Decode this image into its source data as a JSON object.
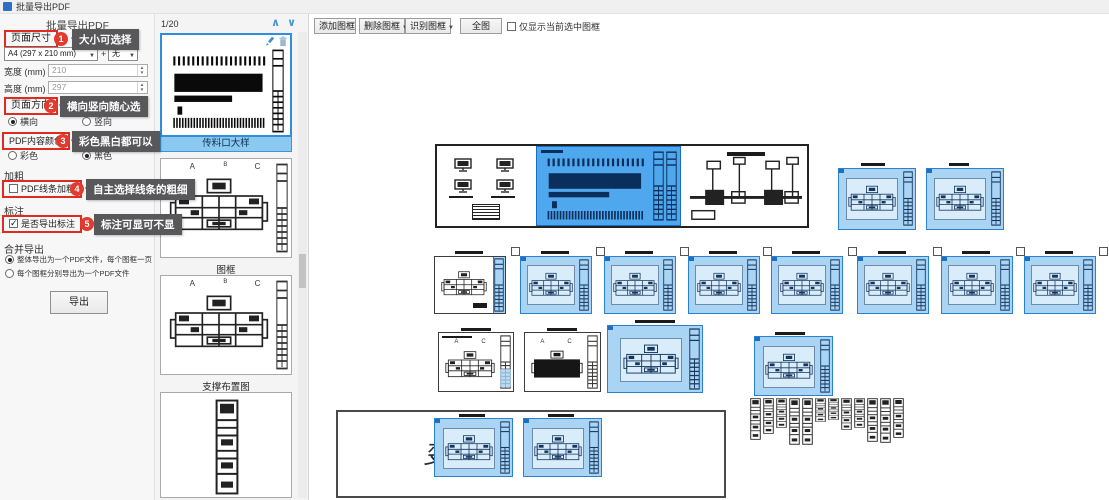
{
  "window": {
    "title": "批量导出PDF"
  },
  "panel": {
    "header": "批量导出PDF",
    "page_size": {
      "label": "页面尺寸",
      "badge": "1",
      "tooltip": "大小可选择",
      "size_value": "A4 (297 x 210 mm)",
      "plus": "+",
      "none_value": "无"
    },
    "width_field": {
      "label": "宽度 (mm)",
      "value": "210"
    },
    "height_field": {
      "label": "高度 (mm)",
      "value": "297"
    },
    "orientation": {
      "label": "页面方向",
      "badge": "2",
      "tooltip": "横向竖向随心选",
      "option_landscape": "横向",
      "option_portrait": "竖向"
    },
    "color": {
      "label": "PDF内容颜色",
      "badge": "3",
      "tooltip": "彩色黑白都可以",
      "option_color": "彩色",
      "option_black": "黑色"
    },
    "bold": {
      "group": "加粗",
      "label": "PDF线条加粗",
      "badge": "4",
      "tooltip": "自主选择线条的粗细"
    },
    "annotation": {
      "group": "标注",
      "label": "是否导出标注",
      "badge": "5",
      "tooltip": "标注可显可不显"
    },
    "merge": {
      "group": "合并导出",
      "options": [
        "整体导出为一个PDF文件，每个图框一页",
        "每个图框分别导出为一个PDF文件"
      ]
    },
    "export_button": "导出"
  },
  "thumbnails": {
    "page_indicator": "1/20",
    "items": [
      {
        "label": "传料口大样"
      },
      {
        "label": "图框"
      },
      {
        "label": "支撑布置图"
      }
    ]
  },
  "toolbar": {
    "add": "添加图框",
    "delete": "删除图框",
    "recognize": "识别图框",
    "full_view": "全图",
    "only_selected": "仅显示当前选中图框"
  },
  "canvas": {
    "plan_labels": {
      "a": "A",
      "b": "B",
      "c": "C"
    },
    "change_floor_note": "变层"
  },
  "icons": {
    "chevron_up": "∧",
    "chevron_down": "∨",
    "dropdown_arrow": "▼",
    "spinner_up": "▲",
    "spinner_down": "▼"
  }
}
